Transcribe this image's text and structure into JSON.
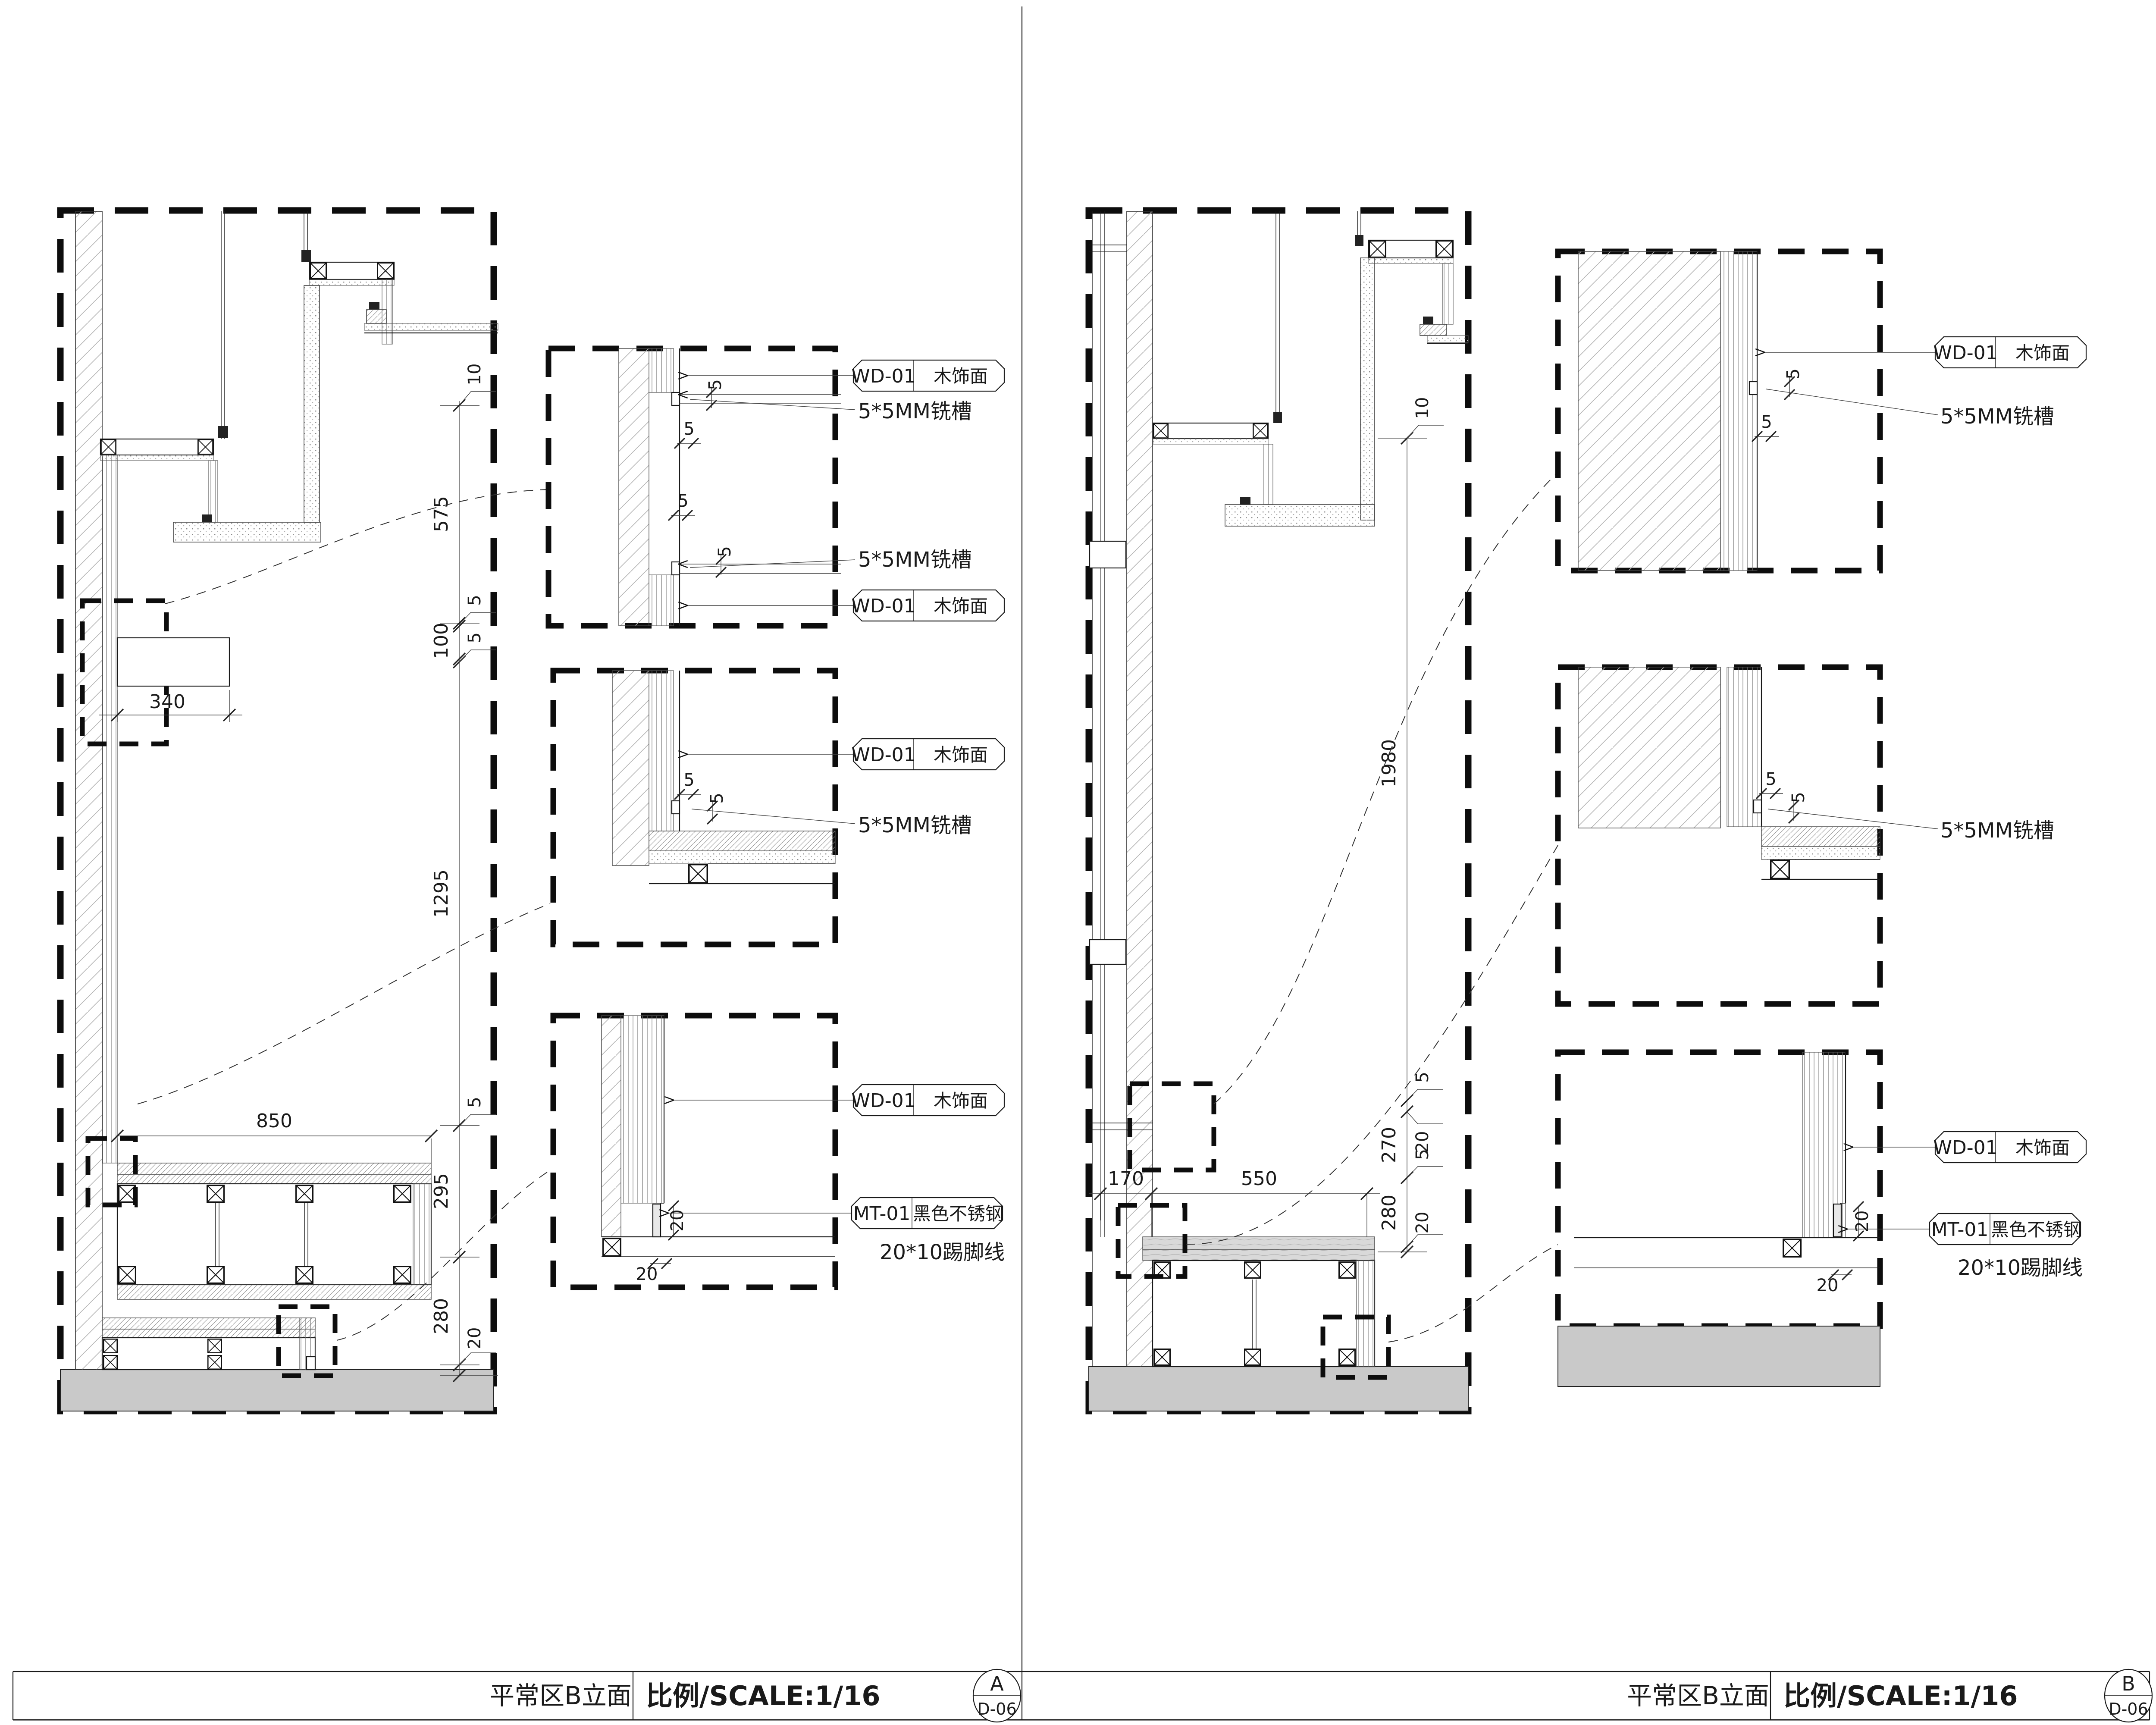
{
  "drawing": {
    "left": {
      "title": "平常区B立面",
      "scale": "比例/SCALE:1/16",
      "ref_letter": "A",
      "ref_sheet": "D-06",
      "chain": [
        "10",
        "575",
        "5",
        "100",
        "5",
        "1295",
        "5",
        "295",
        "280",
        "20"
      ],
      "horiz": [
        "340",
        "850"
      ]
    },
    "right": {
      "title": "平常区B立面",
      "scale": "比例/SCALE:1/16",
      "ref_letter": "B",
      "ref_sheet": "D-06",
      "chain": [
        "10",
        "1980",
        "5",
        "20",
        "270",
        "5",
        "280",
        "20"
      ],
      "horiz": [
        "170",
        "550"
      ]
    },
    "labels": {
      "wd_code": "WD-01",
      "wd_name": "木饰面",
      "mt_code": "MT-01",
      "mt_name": "黑色不锈钢",
      "groove": "5*5MM铣槽",
      "skirting": "20*10踢脚线",
      "five": "5",
      "twenty": "20"
    },
    "colors": {
      "line": "#1a1a1a",
      "floor_fill": "#c9c9c9",
      "hatch": "#b3b3b3"
    }
  }
}
